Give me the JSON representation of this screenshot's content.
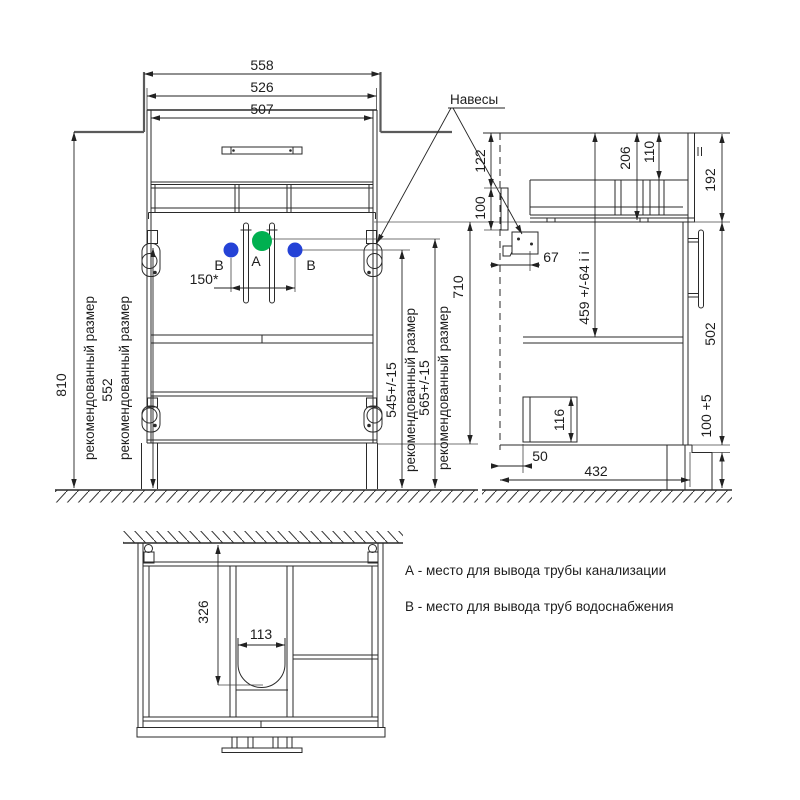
{
  "callout": {
    "hangers": "Навесы"
  },
  "front": {
    "width_outer": "558",
    "width_cabinet": "526",
    "width_drawer": "507",
    "height_niche": "810",
    "height_hanger": "552",
    "height_b": "545+/-15",
    "height_a": "565+/-15",
    "height_cabinet": "710",
    "b_spacing": "150*",
    "rec_label": "рекомендованный размер",
    "label_a": "А",
    "label_b": "В"
  },
  "side": {
    "d122": "122",
    "d100": "100",
    "d67": "67",
    "d206": "206",
    "d110": "110",
    "d459": "459 +/-64 i i",
    "d192": "192",
    "d502": "502",
    "d100p5": "100 +5",
    "d116": "116",
    "d50": "50",
    "d432": "432"
  },
  "bottom": {
    "d326": "326",
    "d113": "113"
  },
  "legend": {
    "a": "А - место для вывода трубы канализации",
    "b": "В - место для вывода труб водоснабжения"
  },
  "colors": {
    "dot_a": "#00b050",
    "dot_b": "#2442d6",
    "ink": "#222222"
  }
}
